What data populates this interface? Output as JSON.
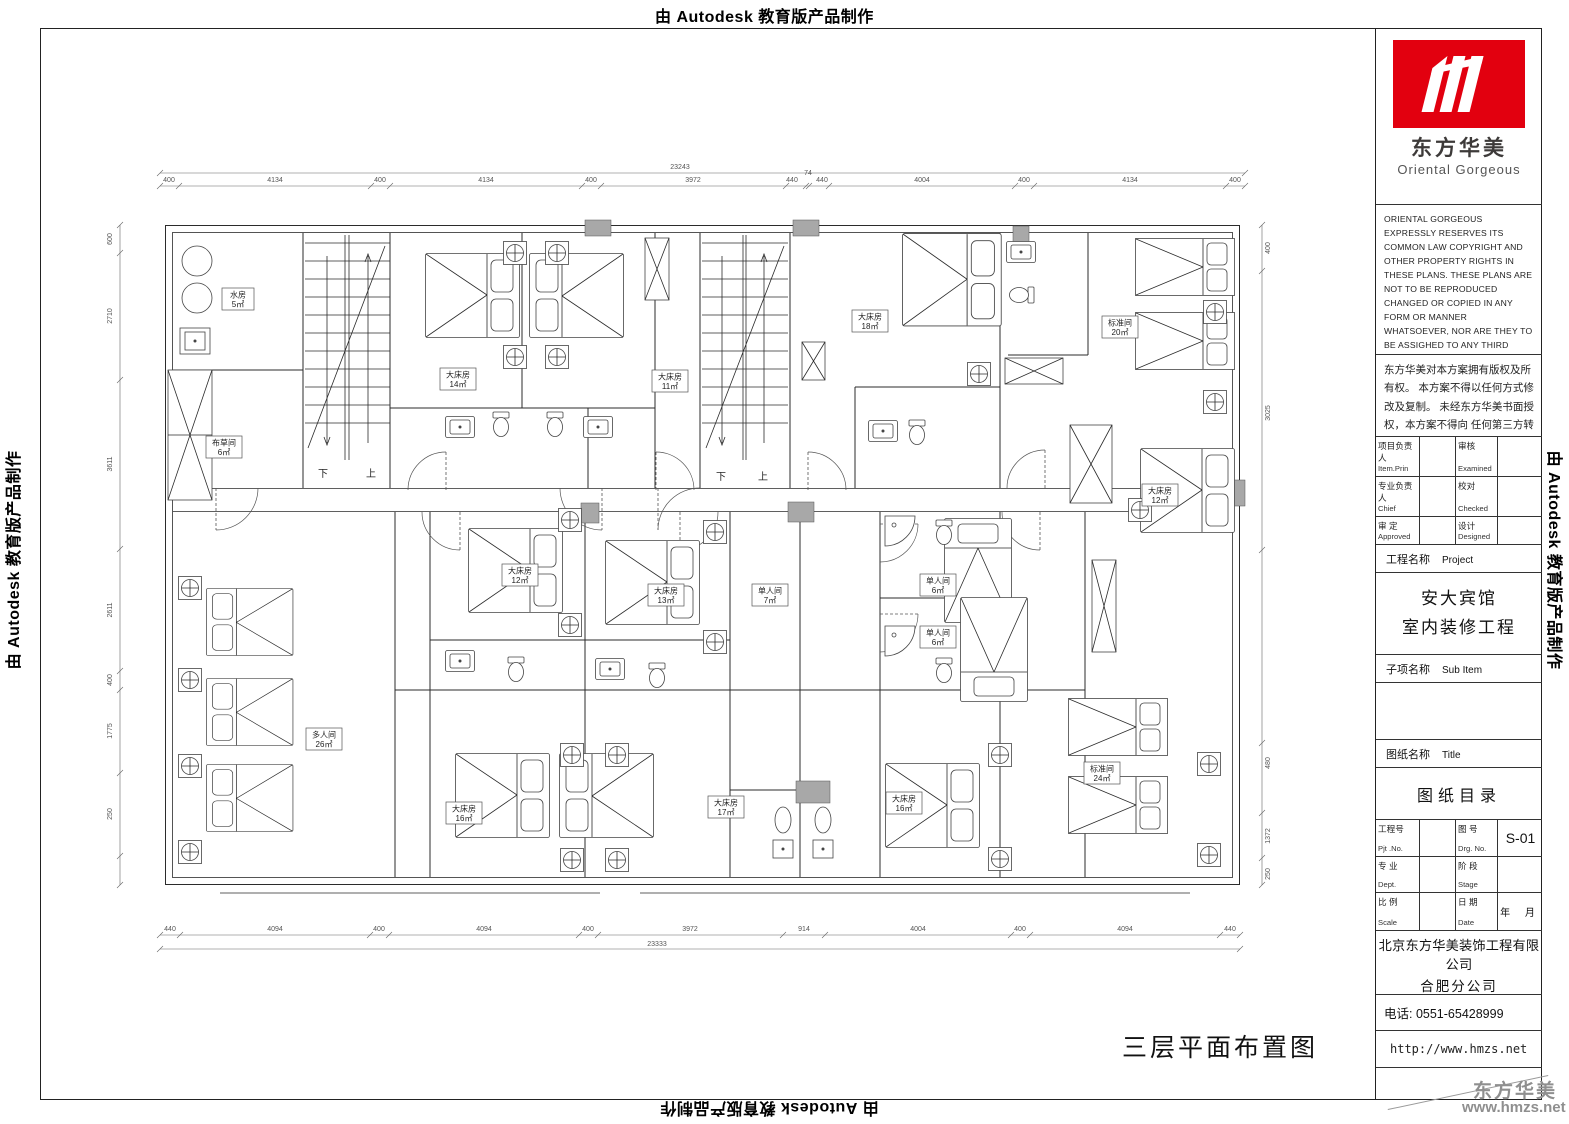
{
  "watermarks": {
    "autodesk": "由 Autodesk 教育版产品制作"
  },
  "brand": {
    "logo_cn": "东方华美",
    "logo_en": "Oriental Gorgeous",
    "corner_cn": "东方华美",
    "corner_url": "www.hmzs.net",
    "accent_color": "#e2000f"
  },
  "title_block": {
    "copyright_en": "ORIENTAL GORGEOUS EXPRESSLY RESERVES ITS COMMON LAW COPYRIGHT AND OTHER PROPERTY RIGHTS IN THESE PLANS. THESE PLANS ARE NOT TO BE REPRODUCED CHANGED OR COPIED IN ANY FORM OR MANNER WHATSOEVER, NOR ARE THEY TO BE ASSIGHED TO ANY THIRD PARTY WITHOUT FIRST OBTAINING THE EXPRESSED WRITTEN PERMISSION AND CONSENT OF ORIENTAL GORGEOUS",
    "copyright_cn": "东方华美对本方案拥有版权及所有权。 本方案不得以任何方式修改及复制。 未经东方华美书面授权，本方案不得向 任何第三方转让。",
    "personnel": {
      "r1c1_cn": "项目负责人",
      "r1c1_en": "Item.Prin",
      "r1c2_cn": "审核",
      "r1c2_en": "Examined",
      "r2c1_cn": "专业负责人",
      "r2c1_en": "Chief",
      "r2c2_cn": "校对",
      "r2c2_en": "Checked",
      "r3c1_cn": "审 定",
      "r3c1_en": "Approved",
      "r3c2_cn": "设计",
      "r3c2_en": "Designed"
    },
    "project": {
      "label_cn": "工程名称",
      "label_en": "Project",
      "line1": "安大宾馆",
      "line2": "室内装修工程"
    },
    "subitem": {
      "label_cn": "子项名称",
      "label_en": "Sub Item"
    },
    "sheet": {
      "label_cn": "图纸名称",
      "label_en": "Title",
      "name": "图纸目录"
    },
    "numbers": {
      "pjt_cn": "工程号",
      "pjt_en": "Pjt .No.",
      "drg_cn": "图 号",
      "drg_en": "Drg. No.",
      "drg_val": "S-01",
      "dept_cn": "专 业",
      "dept_en": "Dept.",
      "stage_cn": "阶 段",
      "stage_en": "Stage",
      "stage_val": "",
      "scale_cn": "比 例",
      "scale_en": "Scale",
      "date_cn": "日 期",
      "date_en": "Date",
      "date_val": "年 月"
    },
    "company": {
      "name": "北京东方华美装饰工程有限公司",
      "branch": "合肥分公司",
      "address": "安徽省合肥市马鞍山南路绿地赢海大厦B座19楼",
      "phone": "电话: 0551-65428999",
      "url": "http://www.hmzs.net"
    }
  },
  "plan": {
    "title": "三层平面布置图",
    "stair_down": "下",
    "stair_up": "上",
    "total_top": "23243",
    "total_bottom": "23333",
    "dims_top": [
      "400",
      "4134",
      "400",
      "4134",
      "400",
      "3972",
      "440",
      "74",
      "440",
      "4004",
      "400",
      "4134",
      "400"
    ],
    "dims_bottom": [
      "440",
      "4094",
      "400",
      "4094",
      "400",
      "3972",
      "914",
      "4004",
      "400",
      "4094",
      "440"
    ],
    "dims_left": [
      "600",
      "2710",
      "3611",
      "2611",
      "400",
      "1775",
      "250"
    ],
    "dims_right": [
      "400",
      "3025",
      "480",
      "1372",
      "250"
    ],
    "rooms": [
      {
        "name": "水房",
        "area": "5㎡"
      },
      {
        "name": "布草间",
        "area": "6㎡"
      },
      {
        "name": "大床房",
        "area": "14㎡"
      },
      {
        "name": "大床房",
        "area": "11㎡"
      },
      {
        "name": "大床房",
        "area": "18㎡"
      },
      {
        "name": "标准间",
        "area": "20㎡"
      },
      {
        "name": "大床房",
        "area": "12㎡"
      },
      {
        "name": "大床房",
        "area": "12㎡"
      },
      {
        "name": "大床房",
        "area": "13㎡"
      },
      {
        "name": "单人间",
        "area": "7㎡"
      },
      {
        "name": "单人间",
        "area": "6㎡"
      },
      {
        "name": "单人间",
        "area": "6㎡"
      },
      {
        "name": "多人间",
        "area": "26㎡"
      },
      {
        "name": "大床房",
        "area": "16㎡"
      },
      {
        "name": "大床房",
        "area": "17㎡"
      },
      {
        "name": "大床房",
        "area": "16㎡"
      },
      {
        "name": "标准间",
        "area": "24㎡"
      }
    ]
  }
}
